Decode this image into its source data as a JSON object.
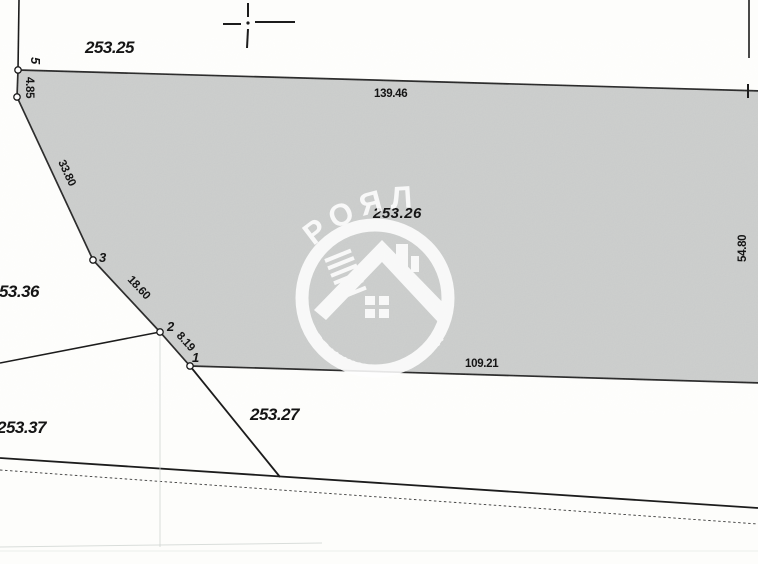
{
  "parcel": {
    "number": "253.26",
    "points": {
      "p5": "5",
      "p3": "3",
      "p2": "2",
      "p1": "1"
    },
    "dims": {
      "top": "139.46",
      "left_vertical": "4.85",
      "edge_5_3": "33.80",
      "edge_3_2": "18.60",
      "edge_2_1": "8.19",
      "bottom": "109.21",
      "right": "54.80"
    }
  },
  "neighbors": {
    "top": "253.25",
    "left": "253.36",
    "bottom_left": "253.37",
    "bottom": "253.27"
  },
  "watermark": {
    "brand": "РОЯЛ",
    "tagline": "НЕДВИЖИМИ ИМОТИ"
  },
  "colors": {
    "parcel_fill": "#c7c9c8",
    "line": "#1c1c1c",
    "watermark_white": "#ffffff",
    "background": "#fdfdfb"
  }
}
